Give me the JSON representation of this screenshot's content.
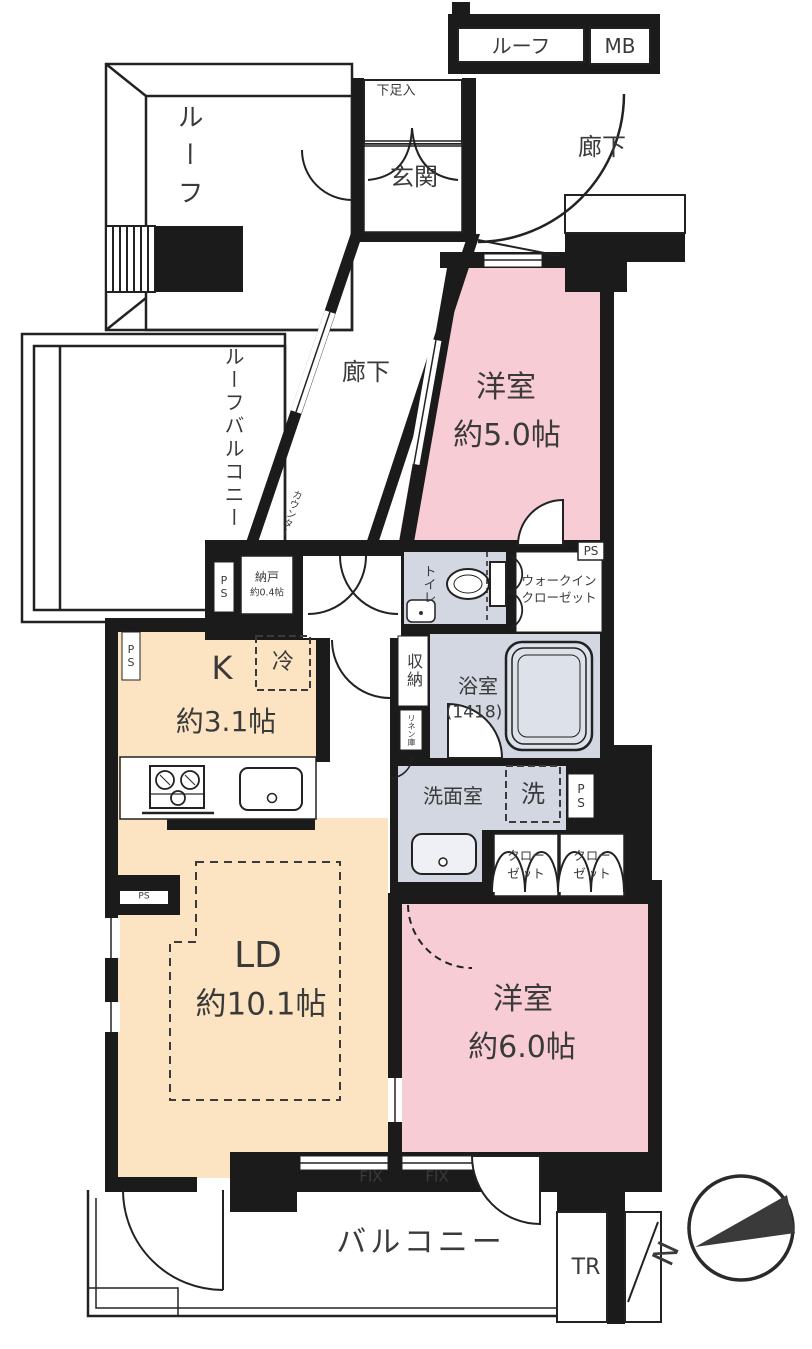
{
  "title": "apartment floor plan",
  "colors": {
    "room_pink": "#f8ccd4",
    "room_peach": "#fce4c3",
    "wet_gray": "#d3d7e2",
    "wall_black": "#1b1b1b",
    "text": "#3a3a3a"
  },
  "labels": {
    "roof_top": "ルーフ",
    "mb": "MB",
    "roof_left": "ルーフ",
    "shoe_box": "下足入",
    "entrance": "玄関",
    "hallway_top": "廊下",
    "hallway_mid": "廊下",
    "roof_balcony": "ルーフバルコニー",
    "counter": "カウンター",
    "storage_name": "納戸",
    "storage_size": "約0.4帖",
    "ps_a": "PS",
    "ps_b": "PS",
    "ps_c": "PS",
    "ps_d": "PS",
    "ps_e": "PS",
    "toilet": "トイレ",
    "wic_line1": "ウォークイン",
    "wic_line2": "クローゼット",
    "western5_name": "洋室",
    "western5_size": "約5.0帖",
    "kitchen_name": "K",
    "kitchen_size": "約3.1帖",
    "fridge": "冷",
    "shuno": "収納",
    "bath_name": "浴室",
    "bath_size": "(1418)",
    "linen": "リネン庫",
    "washroom": "洗面室",
    "washer": "洗",
    "closet1_line1": "クロー",
    "closet1_line2": "ゼット",
    "closet2_line1": "クロー",
    "closet2_line2": "ゼット",
    "ld_name": "LD",
    "ld_size": "約10.1帖",
    "western6_name": "洋室",
    "western6_size": "約6.0帖",
    "fix1": "FIX",
    "fix2": "FIX",
    "balcony": "バルコニー",
    "tr": "TR",
    "north": "N"
  }
}
